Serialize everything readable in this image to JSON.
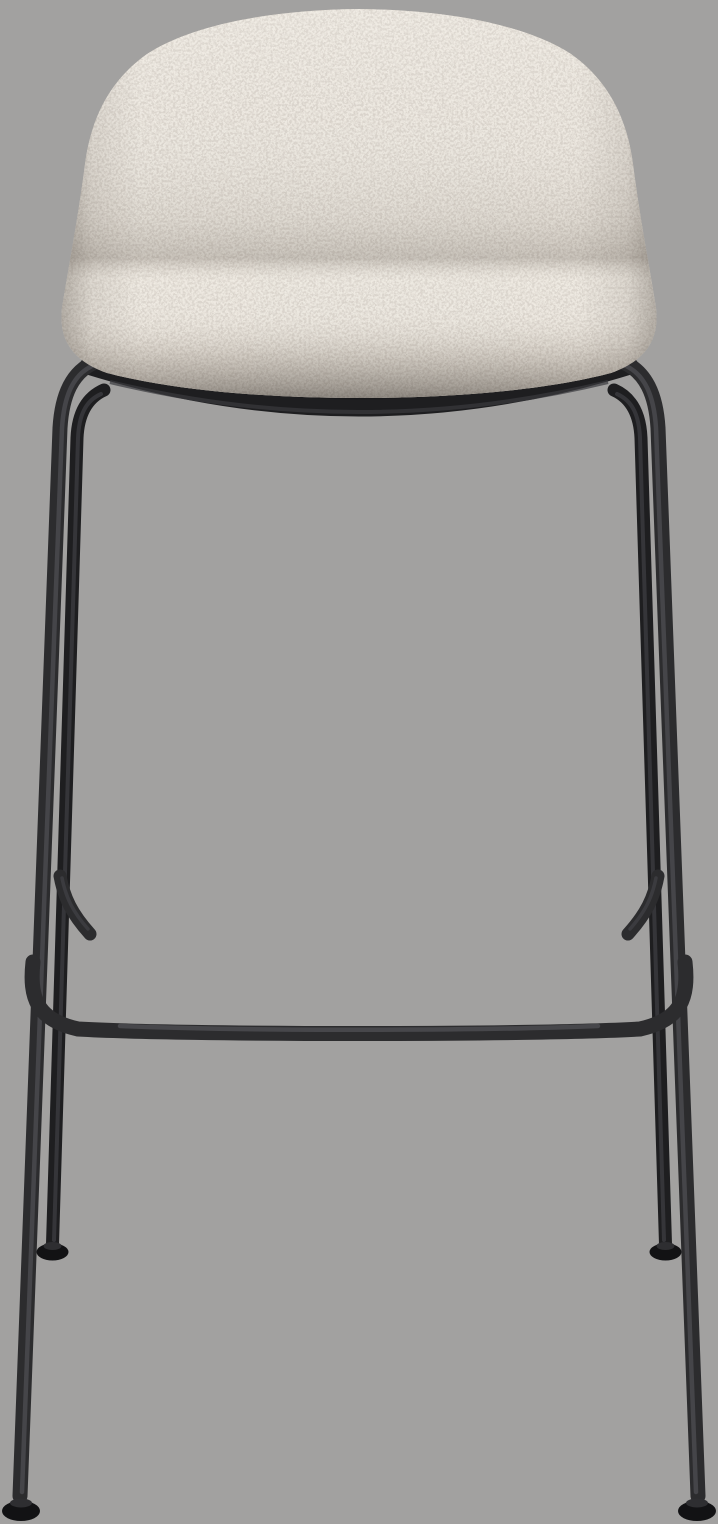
{
  "image": {
    "kind": "product-photo",
    "subject": "bar stool",
    "alt": "Front view of a bar stool with a light beige boucle upholstered seat shell and a black tubular steel four-leg frame with a wraparound footrest and round floor glides",
    "background_color": "#a2a1a0"
  },
  "stool": {
    "seat": {
      "upholstery": "boucle fabric",
      "color_base": "#c5bcb1",
      "color_light": "#ded6ca",
      "color_dark": "#8b8379"
    },
    "frame": {
      "finish": "black steel",
      "color_base": "#2c2c2e",
      "color_dark": "#1e1e20",
      "color_highlight": "#48484c",
      "color_feet": "#121214",
      "parts": [
        "front-left-leg",
        "front-right-leg",
        "rear-left-leg",
        "rear-right-leg",
        "seat-rail",
        "footrest-bar",
        "side-stretchers",
        "floor-glides"
      ]
    }
  }
}
